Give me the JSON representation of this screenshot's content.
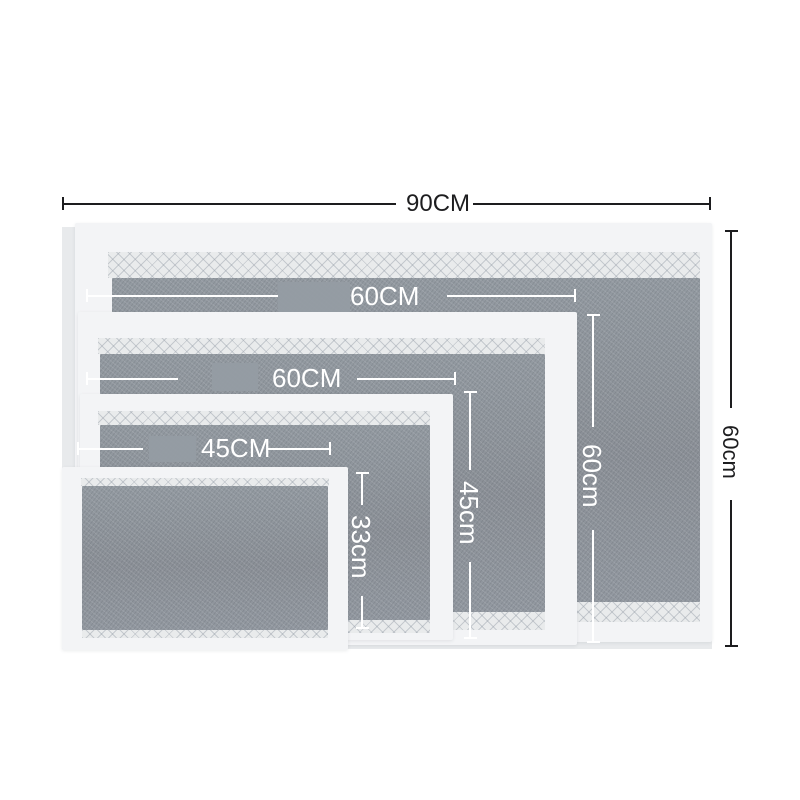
{
  "labels": {
    "overall_width": "90CM",
    "overall_height": "60cm",
    "inner_width_1": "60CM",
    "inner_width_2": "60CM",
    "inner_width_3": "45CM",
    "inner_height_1": "60cm",
    "inner_height_2": "45cm",
    "inner_height_3": "33cm"
  },
  "colors": {
    "backdrop": "#e8eaec",
    "pad_border_white": "#f3f4f6",
    "pad_fill_gray": "#8e939a",
    "quilt_strip": "#e9ebec",
    "dimension_black": "#1d1d1f",
    "dimension_white": "#ffffff",
    "watermark_patch": "#959ca3"
  }
}
